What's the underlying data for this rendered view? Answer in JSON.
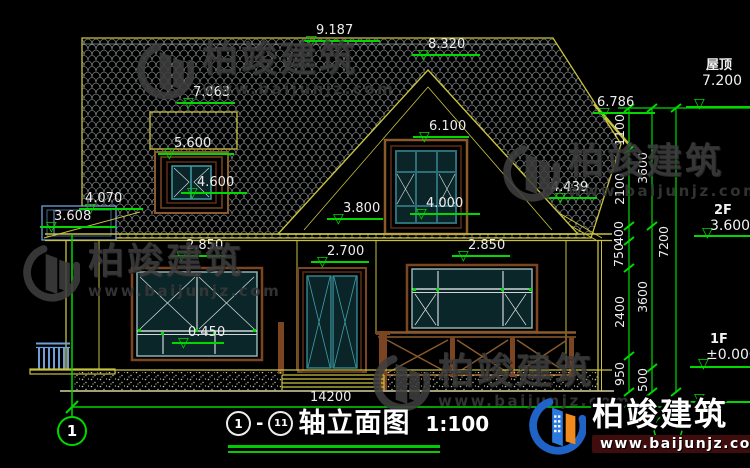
{
  "drawing": {
    "elevation_markers": [
      {
        "value": "9.187"
      },
      {
        "value": "8.320"
      },
      {
        "value": "7.063"
      },
      {
        "value": "5.600"
      },
      {
        "value": "4.600"
      },
      {
        "value": "6.100"
      },
      {
        "value": "4.000"
      },
      {
        "value": "4.439"
      },
      {
        "value": "6.786"
      },
      {
        "value": "3.800"
      },
      {
        "value": "4.070"
      },
      {
        "value": "3.608"
      },
      {
        "value": "2.850"
      },
      {
        "value": "2.700"
      },
      {
        "value": "2.850"
      },
      {
        "value": "0.450"
      }
    ],
    "level_markers": [
      {
        "label": "屋顶",
        "value": "7.200"
      },
      {
        "label": "2F",
        "value": "3.600"
      },
      {
        "label": "1F",
        "value": "±0.000"
      }
    ],
    "vertical_dims": [
      "1100",
      "2100",
      "400",
      "750",
      "2400",
      "950",
      "3600",
      "3600",
      "500",
      "7200"
    ],
    "overall_width_dim": "14200",
    "axis_left": "1"
  },
  "title_block": {
    "axis_start": "1",
    "separator": "-",
    "axis_end": "11",
    "title": "轴立面图",
    "scale": "1:100"
  },
  "watermark": {
    "brand": "柏竣建筑",
    "url": "www.baijunjz.com"
  },
  "colors": {
    "dim_green": "#00d800",
    "line_yellow": "#c9c23f",
    "frame_teal": "#3e9ea8",
    "wood_brown": "#7a4520",
    "brand_blue": "#1f63c6",
    "brand_orange": "#f08a1d"
  }
}
